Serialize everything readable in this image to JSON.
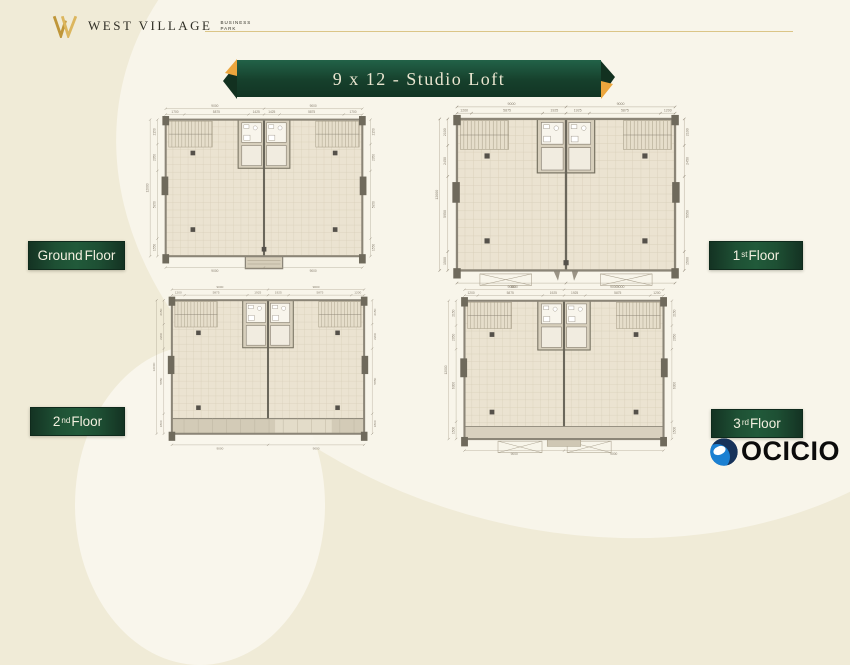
{
  "header": {
    "brand": "WEST VILLAGE",
    "brand_sub1": "BUSINESS",
    "brand_sub2": "PARK"
  },
  "title_banner": {
    "text": "9 x 12 - Studio Loft"
  },
  "colors": {
    "background_cream": "#f0ebd7",
    "background_light": "#f8f5ea",
    "ribbon_green": "#17472f",
    "ribbon_gold": "#eca63d",
    "label_green": "#1e5034",
    "logo_gold": "#c49a3c",
    "watermark_blue": "#1b80d2",
    "watermark_navy": "#16325a",
    "plan_floor": "#ebe3d1",
    "plan_wall": "#8b8577"
  },
  "floor_labels": [
    {
      "text1": "Ground",
      "sup": "",
      "text2": " Floor"
    },
    {
      "text1": "1",
      "sup": "st",
      "text2": " Floor"
    },
    {
      "text1": "2",
      "sup": "nd",
      "text2": " Floor"
    },
    {
      "text1": "3",
      "sup": "rd",
      "text2": " Floor"
    }
  ],
  "watermark": {
    "text": "OCICIO"
  },
  "plans": [
    {
      "name": "ground-floor",
      "variant": "entry",
      "dims": {
        "top_totals": [
          "9000",
          "9000"
        ],
        "top_segs": [
          "1700",
          "5875",
          "1425",
          "1425",
          "5875",
          "1700"
        ],
        "left_total": "12000",
        "left_segs": [
          "2150",
          "2350",
          "5950",
          "1550"
        ],
        "bottom_totals": [
          "9000",
          "9000"
        ]
      }
    },
    {
      "name": "first-floor",
      "variant": "open",
      "dims": {
        "top_totals": [
          "9000",
          "9000"
        ],
        "top_segs": [
          "1200",
          "5875",
          "1925",
          "1925",
          "5875",
          "1200"
        ],
        "left_total": "12000",
        "left_segs": [
          "2100",
          "2450",
          "5950",
          "1500"
        ],
        "bottom_totals": [
          "9000",
          "9000"
        ]
      }
    },
    {
      "name": "second-floor",
      "variant": "corridor",
      "dims": {
        "top_totals": [
          "9000",
          "9000"
        ],
        "top_segs": [
          "1200",
          "5875",
          "1925",
          "1925",
          "5875",
          "1200"
        ],
        "left_total": "12000",
        "left_segs": [
          "2150",
          "2200",
          "5850",
          "1800"
        ],
        "bottom_totals": [
          "9000",
          "9000"
        ]
      }
    },
    {
      "name": "third-floor",
      "variant": "void",
      "dims": {
        "top_totals": [
          "9000",
          "9000"
        ],
        "top_segs": [
          "1200",
          "5875",
          "1925",
          "1925",
          "5875",
          "1200"
        ],
        "left_total": "12000",
        "left_segs": [
          "2150",
          "2050",
          "6300",
          "1500"
        ],
        "bottom_totals": [
          "9000",
          "9000"
        ]
      }
    }
  ]
}
